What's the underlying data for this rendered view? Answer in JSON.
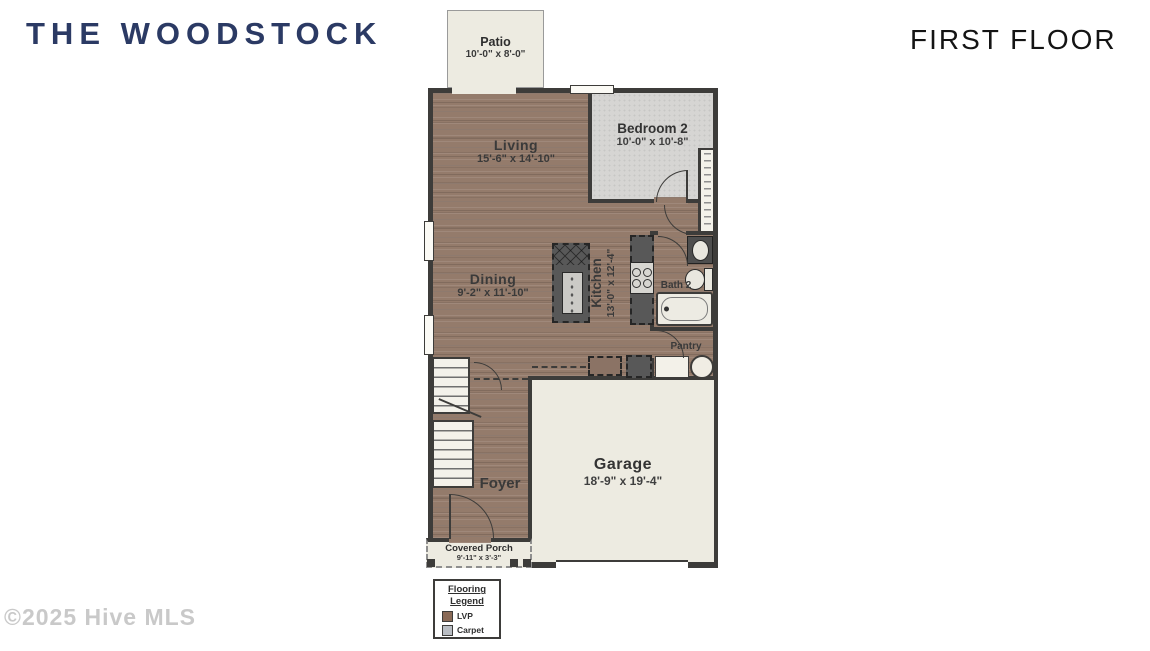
{
  "header": {
    "title": "THE WOODSTOCK",
    "floor_label": "FIRST FLOOR"
  },
  "footer": {
    "copyright": "©2025 Hive MLS"
  },
  "plan": {
    "rooms": {
      "patio": {
        "name": "Patio",
        "dims": "10'-0\" x 8'-0\""
      },
      "living": {
        "name": "Living",
        "dims": "15'-6\" x 14'-10\""
      },
      "bedroom2": {
        "name": "Bedroom 2",
        "dims": "10'-0\" x 10'-8\""
      },
      "dining": {
        "name": "Dining",
        "dims": "9'-2\" x 11'-10\""
      },
      "kitchen": {
        "name": "Kitchen",
        "dims": "13'-0\" x 12'-4\""
      },
      "bath2": {
        "name": "Bath 2"
      },
      "pantry": {
        "name": "Pantry"
      },
      "garage": {
        "name": "Garage",
        "dims": "18'-9\" x 19'-4\""
      },
      "foyer": {
        "name": "Foyer"
      },
      "covered_porch": {
        "name": "Covered Porch",
        "dims": "9'-11\" x 3'-3\""
      }
    },
    "legend": {
      "title_line1": "Flooring",
      "title_line2": "Legend",
      "items": [
        {
          "label": "LVP",
          "color": "#8a6a57"
        },
        {
          "label": "Carpet",
          "color": "#b9bdc3"
        }
      ]
    },
    "colors": {
      "title_navy": "#2b3a64",
      "wall": "#3d3c3a",
      "lvp_floor": "#947b6b",
      "carpet": "#d6d5d3",
      "concrete": "#edebe1"
    }
  }
}
